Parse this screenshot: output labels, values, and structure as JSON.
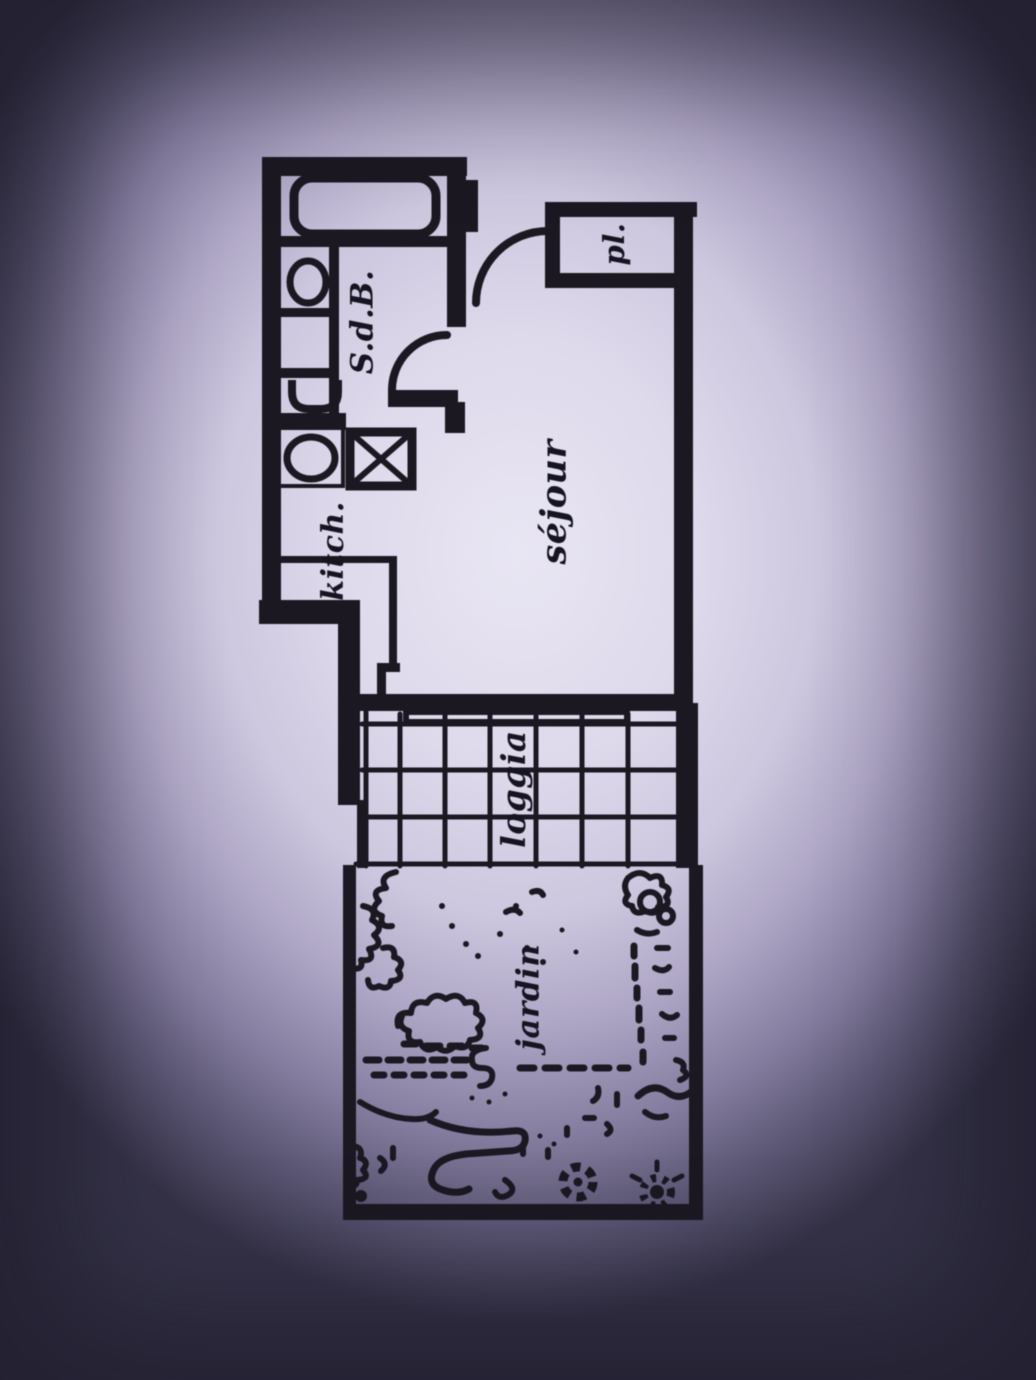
{
  "plan_labels": {
    "bathroom": "S.d.B.",
    "closet": "pl.",
    "kitchen": "kitch.",
    "living_room": "séjour",
    "loggia": "loggia",
    "garden": "jardin"
  },
  "colors": {
    "ink": "#1b1822",
    "paper_highlight": "#e9e6f4",
    "vignette_dark": "#363349"
  }
}
